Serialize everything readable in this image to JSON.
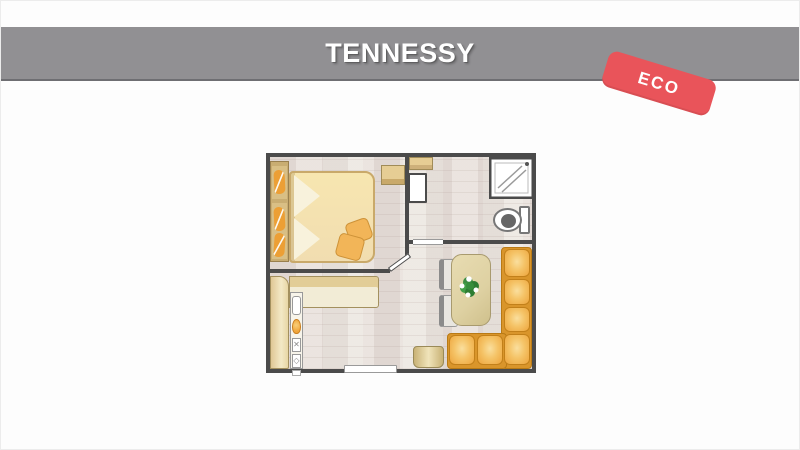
{
  "header": {
    "title": "TENNESSY"
  },
  "badge": {
    "label": "ECO"
  },
  "plan": {
    "rooms": [
      "bedroom",
      "bathroom",
      "kitchen",
      "living-area"
    ],
    "furniture": [
      "wardrobe",
      "double-bed",
      "pillows",
      "bed-cushions",
      "overhead-cabinets",
      "bathroom-door",
      "shower",
      "toilet",
      "kitchen-counter",
      "sink",
      "fruit-basket",
      "stove-burners",
      "dining-table",
      "plant-centerpiece",
      "chairs",
      "corner-sofa",
      "stool",
      "entrance-door"
    ],
    "glyphs": {
      "burner_x": "✕",
      "burner_diamond": "◇"
    }
  },
  "colors": {
    "banner": "#919093",
    "banner_edge": "#6e6e72",
    "title": "#ffffff",
    "badge": "#e9545a",
    "badge_text": "#ffffff",
    "wall": "#4b4b4b",
    "floor": "#ece8e3",
    "door_white": "#ffffff",
    "bed": "#f7e6b0",
    "bed_border": "#c9a96a",
    "pillow": "#f8f2dc",
    "cushion": "#f2b558",
    "cushion_border": "#cd9238",
    "wardrobe": "#d9bf85",
    "wardrobe_item": "#ec9f35",
    "cabinet": "#e6cd94",
    "counter": "#f2ecd6",
    "counter_band": "#e2cd97",
    "basket": "#f0a53a",
    "table": "#ded1a2",
    "table_border": "#a89a6e",
    "chair_seat": "#e8e6e1",
    "chair_back": "#8b8b8b",
    "sofa": "#eda43c",
    "sofa_light": "#fadf9e",
    "sofa_dark": "#d9952b",
    "sofa_border": "#c2801a",
    "fixture_border": "#777777"
  }
}
